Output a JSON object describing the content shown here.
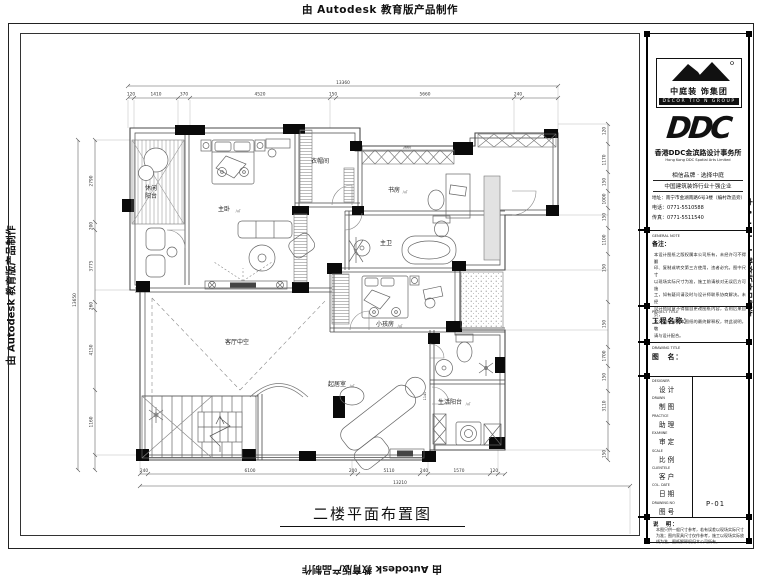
{
  "page": {
    "edu_notice": "由 Autodesk 教育版产品制作"
  },
  "plan": {
    "title": "二楼平面布置图",
    "rooms": {
      "leisure_l1": "休闲",
      "leisure_l2": "阳台",
      "master": "主卧",
      "cloak": "衣帽间",
      "study": "书房",
      "mbath": "主卫",
      "kids": "小孩房",
      "voidspace": "客厅中空",
      "family": "起居室",
      "service": "生活阳台",
      "suffix": "/㎡"
    },
    "dims": {
      "top_total": "13360",
      "top": [
        "120",
        "1410",
        "370",
        "4520",
        "150",
        "5660",
        "240"
      ],
      "left_total": "13650",
      "left": [
        "2790",
        "200",
        "3775",
        "260",
        "4150",
        "1160"
      ],
      "right": [
        "120",
        "1170",
        "150",
        "1000",
        "150",
        "1100",
        "150",
        "150",
        "1700",
        "150",
        "3110",
        "150"
      ],
      "bottom": [
        "240",
        "6100",
        "200",
        "5110",
        "240",
        "1570",
        "120"
      ],
      "bottom_total": "13210",
      "inner": [
        "3660",
        "1140"
      ]
    }
  },
  "titleblock": {
    "company": {
      "name_cn": "中庭装 饰集团",
      "name_en": "DECOR TIO N GROUP",
      "ddc": "DDC",
      "ddc_cn": "香港DDC金滨路设计事务所",
      "ddc_en": "Hong Kong DDC Spatial Arts Limited",
      "slogan": "相信品牌 · 选择中庭",
      "honor": "中国建筑装饰行业十强企业",
      "address": "地址：南宁市金湖南路6号3楼（编村改造旁）",
      "phone": "电话：0771-5510588",
      "fax": "传真：0771-5511540"
    },
    "gnote": {
      "en": "GENERAL NOTE",
      "cn": "备注：",
      "lines": [
        "本设计图纸之版权属本公司所有，未经许可不得翻",
        "印、复制或转交第三方使用，违者必究。图中尺寸",
        "以现场实际尺寸为准，施工前请核对无误后方可施",
        "工，如有疑问请及时与设计师联系协商解决。未经",
        "设计师同意不得擅自更改图纸内容，否则后果自负，",
        "本公司保留对本图纸的最终解释权，特此说明，敬",
        "请与设计配合。"
      ]
    },
    "project": {
      "en": "PROJECT TITLE",
      "cn": "工程名称："
    },
    "drawing": {
      "en": "DRAWING TITLE",
      "cn": "图　名："
    },
    "fields": [
      {
        "en": "DESIGNER",
        "cn": "设计",
        "value": ""
      },
      {
        "en": "DRAWN",
        "cn": "制图",
        "value": ""
      },
      {
        "en": "PRACTICE",
        "cn": "助理",
        "value": ""
      },
      {
        "en": "EXAMINE",
        "cn": "审定",
        "value": ""
      },
      {
        "en": "SCALE",
        "cn": "比例",
        "value": ""
      },
      {
        "en": "CLIENTELE",
        "cn": "客户",
        "value": ""
      },
      {
        "en": "COL. DATE",
        "cn": "日期",
        "value": ""
      },
      {
        "en": "DRAWING NO",
        "cn": "图号",
        "value": "P-01"
      }
    ],
    "note": {
      "label": "说　明：",
      "lines": [
        "本图只供一般尺寸参考，若有误差以现场实际尺寸",
        "为准；图内家具尺寸仅作参考，施工以现场实际放",
        "线为准，图纸解释权归本公司所有。"
      ]
    }
  }
}
